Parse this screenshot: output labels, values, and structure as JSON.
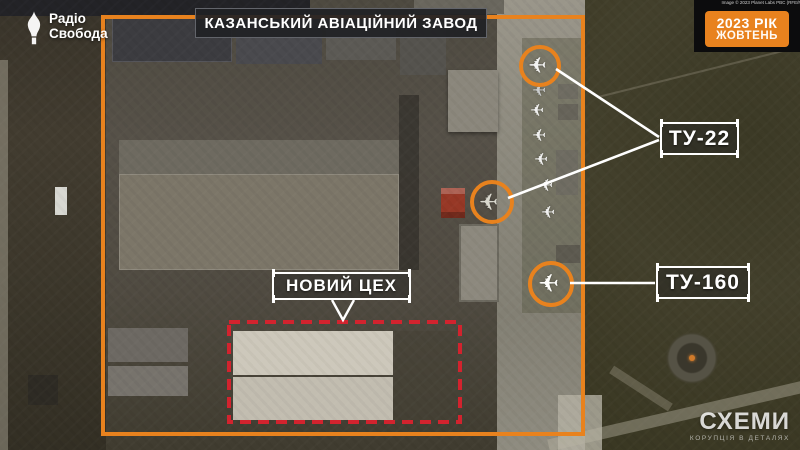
{
  "header": {
    "title": "КАЗАНСЬКИЙ АВІАЦІЙНИЙ ЗАВОД"
  },
  "credit": "Image © 2023 Planet Labs PBC (RFE/RL Graphics)",
  "date_badge": {
    "year": "2023 РІК",
    "month": "ЖОВТЕНЬ"
  },
  "annotations": {
    "tu22_label": "ТУ-22",
    "tu160_label": "ТУ-160",
    "new_workshop_label": "НОВИЙ ЦЕХ"
  },
  "branding": {
    "radio_svoboda_line1": "Радіо",
    "radio_svoboda_line2": "Свобода",
    "schemes_title": "СХЕМИ",
    "schemes_tagline": "КОРУПЦІЯ В ДЕТАЛЯХ"
  },
  "icons": {
    "aircraft_glyph": "✈"
  },
  "colors": {
    "accent_orange": "#E8821E",
    "alert_red": "#D2232E",
    "label_border": "#FFFFFF",
    "badge_background": "#0C0C0D"
  }
}
